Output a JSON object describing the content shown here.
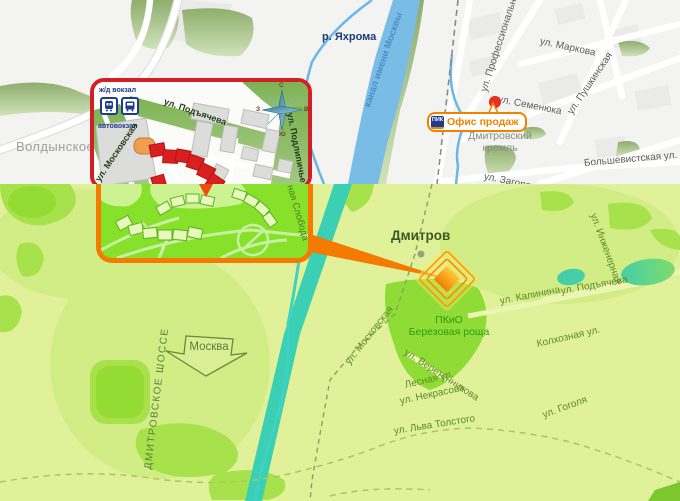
{
  "top_map": {
    "area_labels": {
      "voldynskoe": "Волдынское",
      "kremlin": "Дмитровский кремль"
    },
    "water_labels": {
      "river": "р. Яхрома",
      "canal": "канал имени Москвы"
    },
    "streets": {
      "professionalnaya": "ул. Профессиональная",
      "markova": "ул. Маркова",
      "semenyuka": "ул. Семенюка",
      "pushkinskaya": "ул. Пушкинская",
      "bolshevistskaya": "Большевистская ул.",
      "zagorskaya": "ул. Загорская"
    },
    "office_badge": {
      "logo": "ПИК",
      "label": "Офис продаж"
    },
    "inset": {
      "transport": {
        "rail": "ж/д вокзал",
        "bus": "автовокзал"
      },
      "streets": {
        "podyacheva": "ул. Подъячева",
        "moskovskaya": "ул. Московская",
        "podlipichye": "ул. Подлипичье"
      },
      "compass": {
        "n": "С",
        "s": "Ю",
        "w": "З",
        "e": "В"
      }
    }
  },
  "bottom_map": {
    "city": "Дмитров",
    "park": {
      "line1": "ПКиО",
      "line2": "Березовая роща"
    },
    "highway": "ДМИТРОВСКОЕ ШОССЕ",
    "moscow_arrow": "Москва",
    "streets": {
      "moskovskaya": "ул. Московская",
      "kalinina": "ул. Калинина",
      "podyacheva": "ул. Подъячева",
      "inzhenernaya": "ул. Инженерная",
      "kolkhoznaya": "Колхозная ул.",
      "veretennikova": "ул. Веретенникова",
      "lesnaya": "Лесная ул.",
      "nekrasova": "ул. Некрасова",
      "lva_tolstogo": "ул. Льва Толстого",
      "gogolya": "ул. Гоголя",
      "sloboda": "ная Слобода"
    }
  },
  "colors": {
    "accent_orange": "#f57a00",
    "inset_border_red": "#d21f26",
    "office_orange": "#f08200",
    "pik_blue": "#1d3c8f",
    "marker_fill_top": "#ffc83c",
    "marker_fill_bottom": "#f08000",
    "canal_blue": "#79bce6",
    "canal_teal": "#3bd0b4",
    "bottom_bg": "#e0f199",
    "inset_green": "#87e12b",
    "red_buildings": "#da1f1f"
  }
}
